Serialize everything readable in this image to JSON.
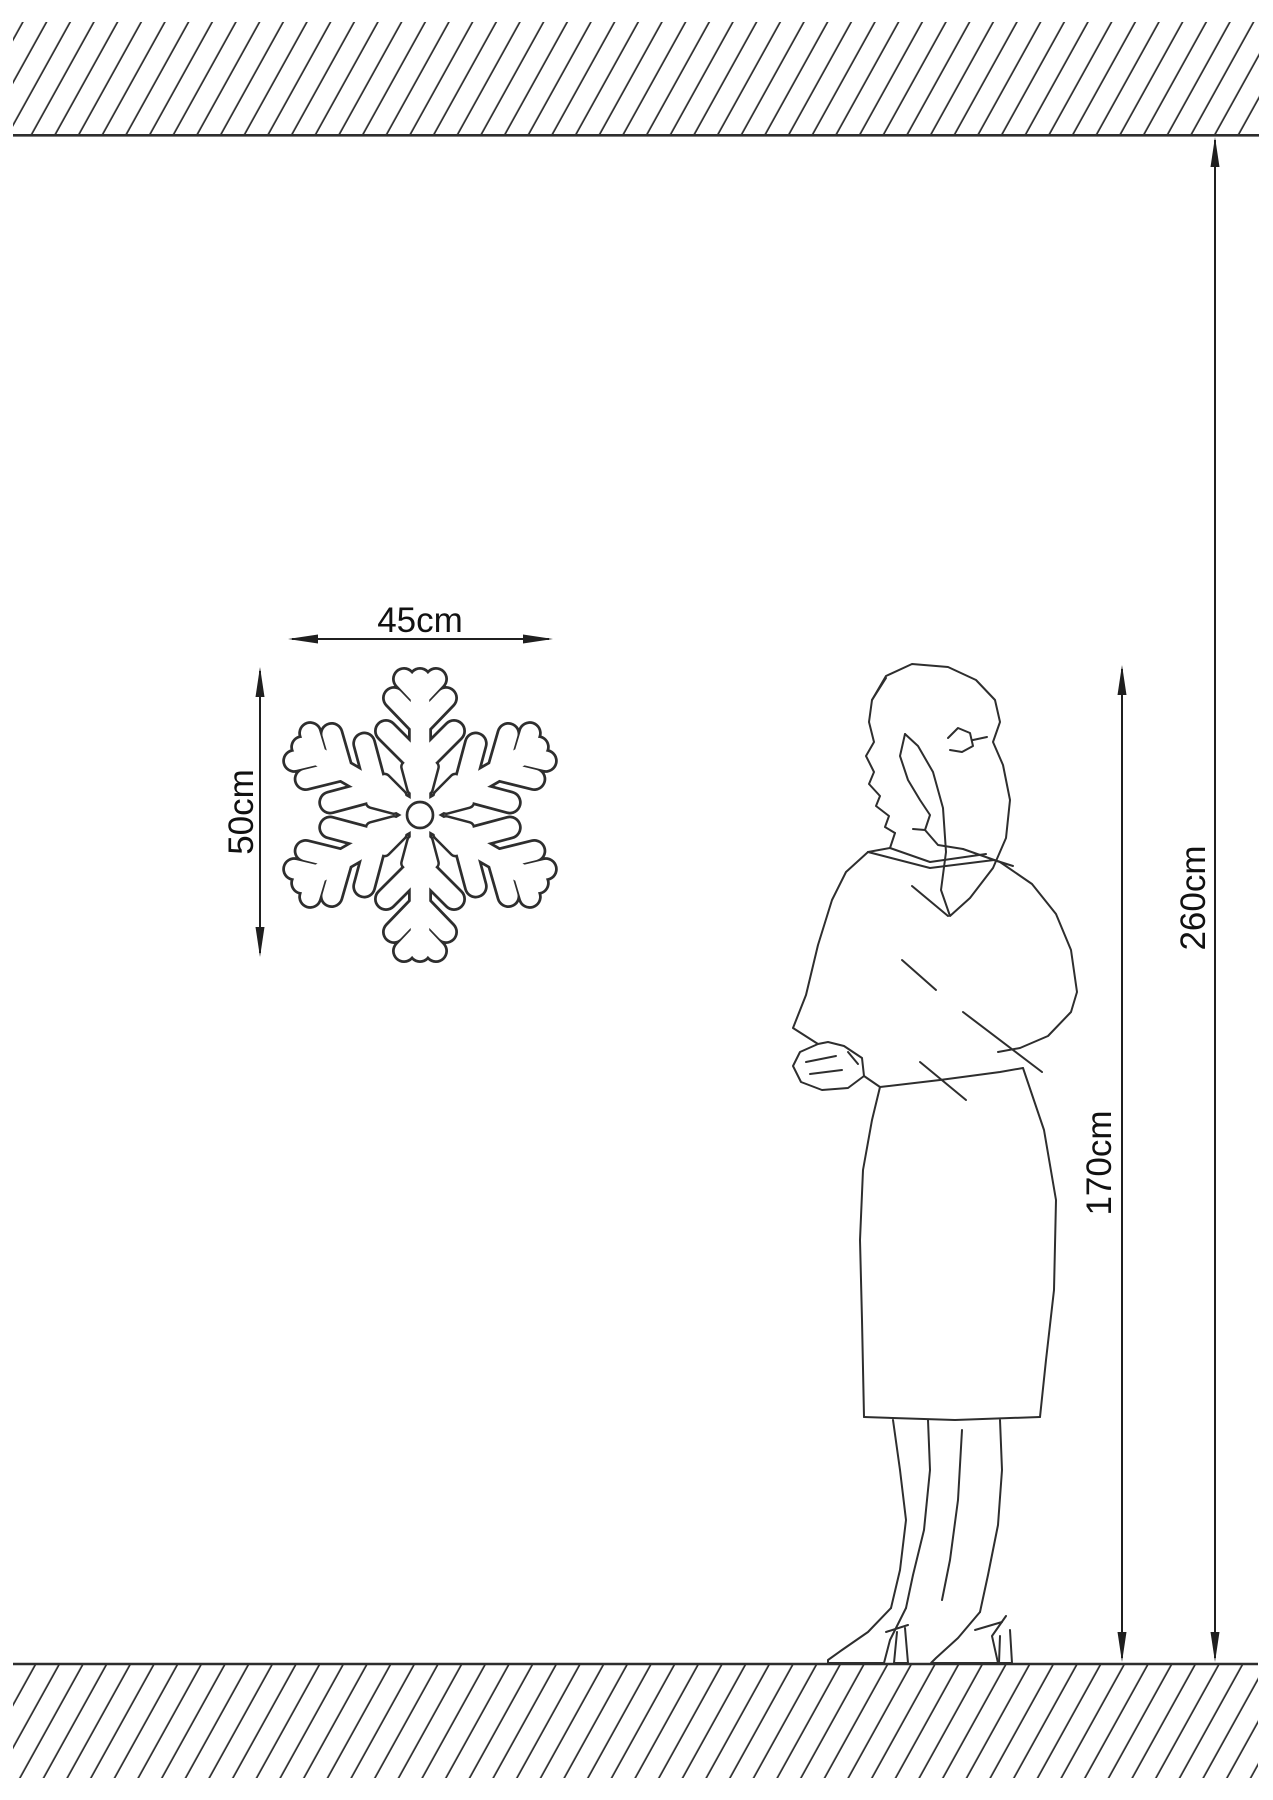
{
  "diagram": {
    "type": "installation-size-diagram",
    "labels": {
      "item_width": "45cm",
      "item_height": "50cm",
      "person_height": "170cm",
      "ceiling_height": "260cm"
    },
    "elements": {
      "ceiling": "hatched ceiling band",
      "floor": "hatched floor band",
      "item": "snowflake wall decoration",
      "person": "standing woman line figure"
    },
    "colors": {
      "background": "#ffffff",
      "line": "#2e2e2e",
      "dimension": "#1f1f1f",
      "label_text": "#111111"
    }
  }
}
